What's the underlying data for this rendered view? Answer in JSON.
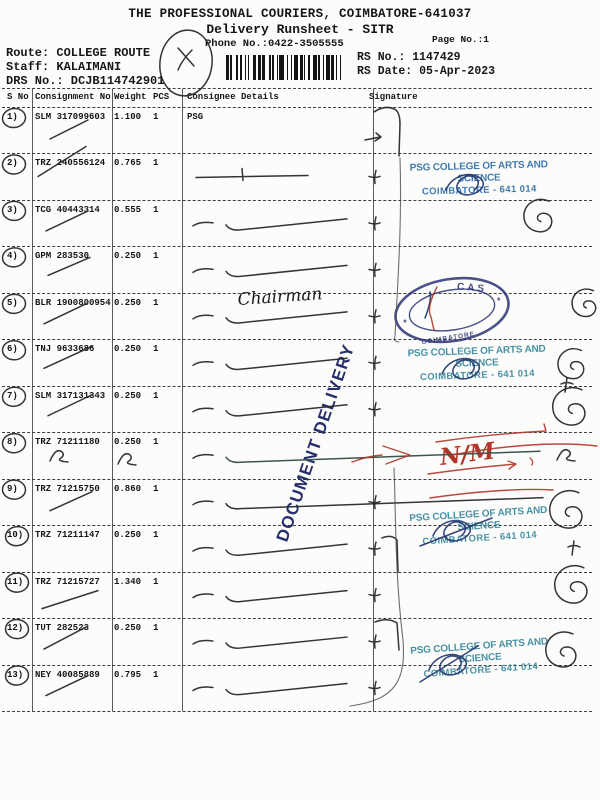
{
  "document": {
    "title": "THE PROFESSIONAL COURIERS, COIMBATORE-641037",
    "subtitle": "Delivery Runsheet - SITR",
    "phone": "Phone No.:0422-3505555",
    "page_no": "Page No.:1",
    "rs_no": "RS No.: 1147429",
    "rs_date": "RS Date: 05-Apr-2023",
    "route": "Route: COLLEGE ROUTE",
    "staff": "Staff: KALAIMANI",
    "drs_no": "DRS No.: DCJB114742901"
  },
  "table": {
    "headers": {
      "sno": "S No",
      "consignment": "Consignment No",
      "weight": "Weight",
      "pcs": "PCS",
      "consignee": "Consignee Details",
      "signature": "Signature"
    },
    "rows": [
      {
        "sno": "1)",
        "consignment": "SLM 317099603",
        "weight": "1.100",
        "pcs": "1",
        "consignee": "PSG"
      },
      {
        "sno": "2)",
        "consignment": "TRZ 240556124",
        "weight": "0.765",
        "pcs": "1",
        "consignee": ""
      },
      {
        "sno": "3)",
        "consignment": "TCG 40443314",
        "weight": "0.555",
        "pcs": "1",
        "consignee": ""
      },
      {
        "sno": "4)",
        "consignment": "GPM 283530",
        "weight": "0.250",
        "pcs": "1",
        "consignee": ""
      },
      {
        "sno": "5)",
        "consignment": "BLR 1900800954",
        "weight": "0.250",
        "pcs": "1",
        "consignee": "",
        "handwritten_consignee": "Chairman"
      },
      {
        "sno": "6)",
        "consignment": "TNJ 9633686",
        "weight": "0.250",
        "pcs": "1",
        "consignee": ""
      },
      {
        "sno": "7)",
        "consignment": "SLM 317131343",
        "weight": "0.250",
        "pcs": "1",
        "consignee": ""
      },
      {
        "sno": "8)",
        "consignment": "TRZ 71211180",
        "weight": "0.250",
        "pcs": "1",
        "consignee": ""
      },
      {
        "sno": "9)",
        "consignment": "TRZ 71215750",
        "weight": "0.860",
        "pcs": "1",
        "consignee": ""
      },
      {
        "sno": "10)",
        "consignment": "TRZ 71211147",
        "weight": "0.250",
        "pcs": "1",
        "consignee": ""
      },
      {
        "sno": "11)",
        "consignment": "TRZ 71215727",
        "weight": "1.340",
        "pcs": "1",
        "consignee": ""
      },
      {
        "sno": "12)",
        "consignment": "TUT 282523",
        "weight": "0.250",
        "pcs": "1",
        "consignee": ""
      },
      {
        "sno": "13)",
        "consignment": "NEY 40085889",
        "weight": "0.795",
        "pcs": "1",
        "consignee": ""
      }
    ]
  },
  "stamps": {
    "psg_line1": "PSG COLLEGE OF ARTS AND SCIENCE",
    "psg_line2": "COIMBATORE - 641 014",
    "document_delivery": "DOCUMENT DELIVERY",
    "seal_top": "CAS",
    "seal_bottom": "COIMBATORE",
    "seal_star": "*"
  },
  "annotations": {
    "red_note": "N/M"
  },
  "colors": {
    "stamp_blue": "#2b6ca8",
    "stamp_teal": "#35879e",
    "seal_navy": "#2a3175",
    "delivery_navy": "#1c2566",
    "red_ink": "#b03527",
    "pen_ink": "#232323"
  }
}
